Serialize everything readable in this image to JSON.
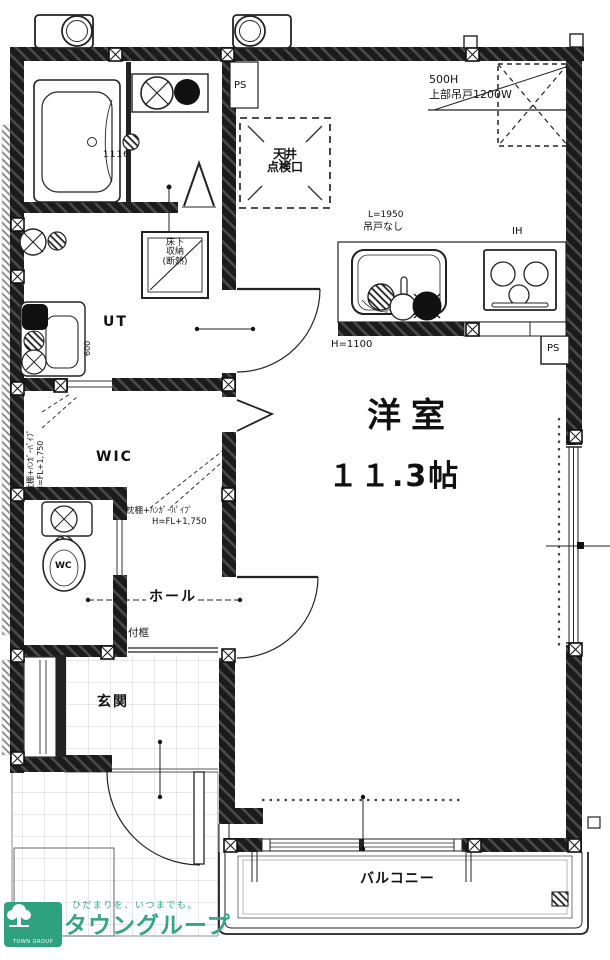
{
  "plan": {
    "ps_top": "PS",
    "ceiling_hatch": {
      "line1": "天井",
      "line2": "点検口"
    },
    "upper_cabinet": {
      "height": "500H",
      "label": "上部吊戸1200W"
    },
    "kitchen": {
      "length": "L=1950",
      "no_hanging_door": "吊戸なし",
      "cooktop": "IH",
      "counter_height": "H=1100",
      "pipe_space": "PS"
    },
    "bath": {
      "unit_size": "1116"
    },
    "floor_storage": {
      "line1": "床下",
      "line2": "収納",
      "line3": "(断熱)"
    },
    "utility": "UT",
    "vanity_width": "600",
    "wic": {
      "name": "WIC"
    },
    "shelf_note": {
      "line1": "枕棚+ﾊﾝｶﾞｰﾊﾟｲﾌﾟ",
      "line2": "H=FL+1,750"
    },
    "toilet": "WC",
    "hall": "ホール",
    "entrance_step": "付框",
    "entrance": "玄関",
    "main_room": {
      "name": "洋室",
      "size": "１１.3帖"
    },
    "balcony": "バルコニー"
  },
  "logo": {
    "tagline": "ひだまりを、いつまでも。",
    "name": "タウングループ",
    "sub": "TOWN GROUP"
  },
  "colors": {
    "wall": "#1b1b1b",
    "accent_green": "#2ea17e",
    "tile_line": "#ccd2d8"
  }
}
